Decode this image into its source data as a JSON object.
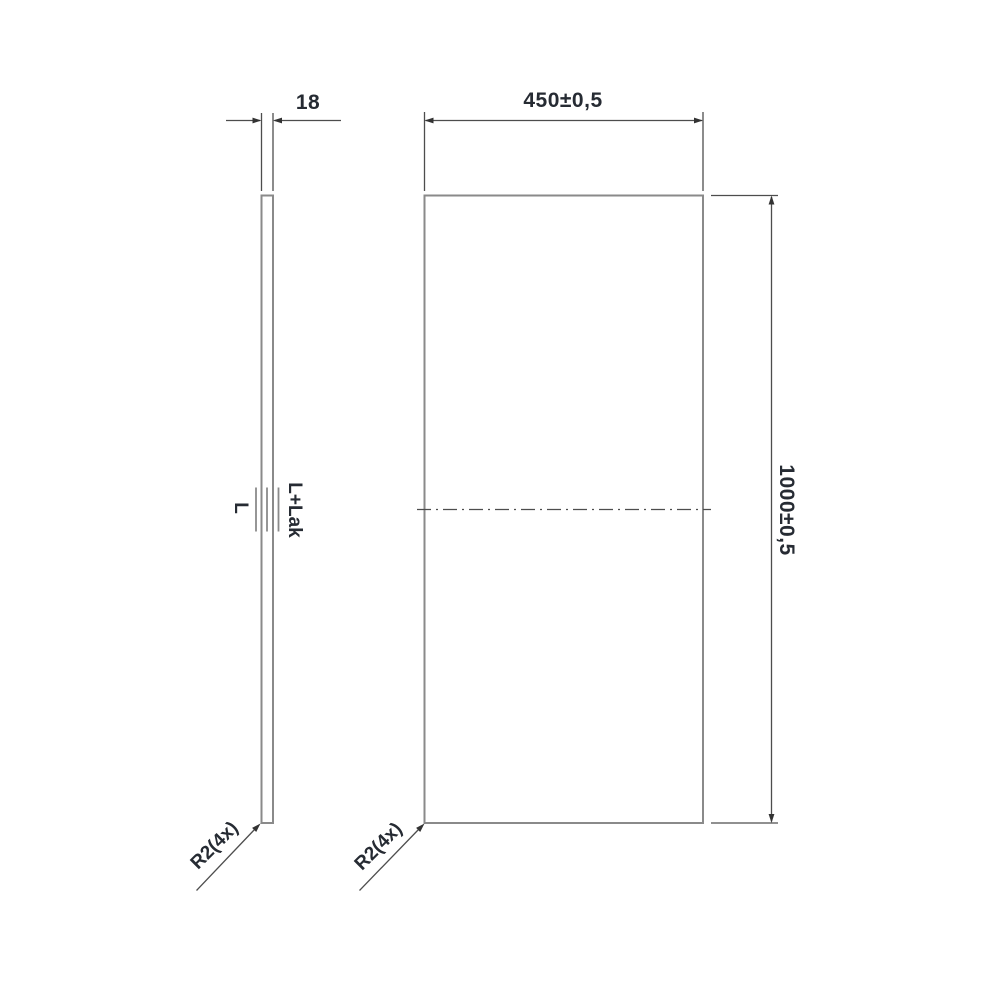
{
  "drawing": {
    "type": "technical dimension drawing of rectangular panel, side view and front view",
    "side_view": {
      "thickness_dimension": "18",
      "core_label": "L",
      "surface_label": "L+Lak",
      "corner_radius_label": "R2(4x)"
    },
    "front_view": {
      "width_dimension": "450±0,5",
      "height_dimension": "1000±0,5",
      "corner_radius_label": "R2(4x)"
    },
    "colors": {
      "background": "#ffffff",
      "outline_gray": "#8a8a8a",
      "dimension_gray": "#4d4d4d",
      "text_dark": "#262b33"
    }
  }
}
